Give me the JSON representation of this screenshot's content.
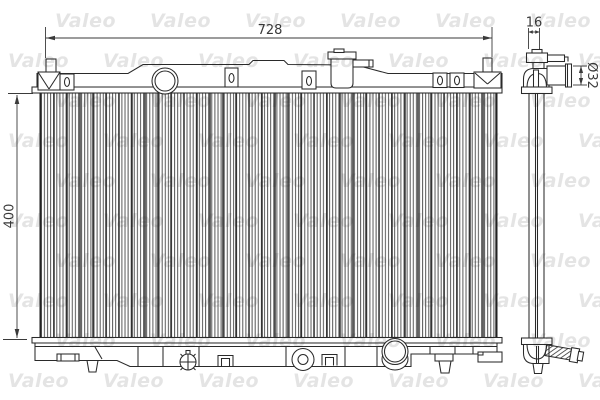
{
  "drawing": {
    "type": "radiator-technical-drawing",
    "views": {
      "front": "radiator front view",
      "side": "radiator side profile view"
    },
    "dimensions": {
      "width": "728",
      "height": "400",
      "core_depth": "16",
      "pipe_diameter": "Ø32"
    },
    "watermark": {
      "text": "Valeo",
      "color": "rgba(30,30,30,0.12)"
    },
    "colors": {
      "line": "#2a2a2a",
      "dim_text": "#3a3a3a",
      "background": "#ffffff"
    }
  }
}
